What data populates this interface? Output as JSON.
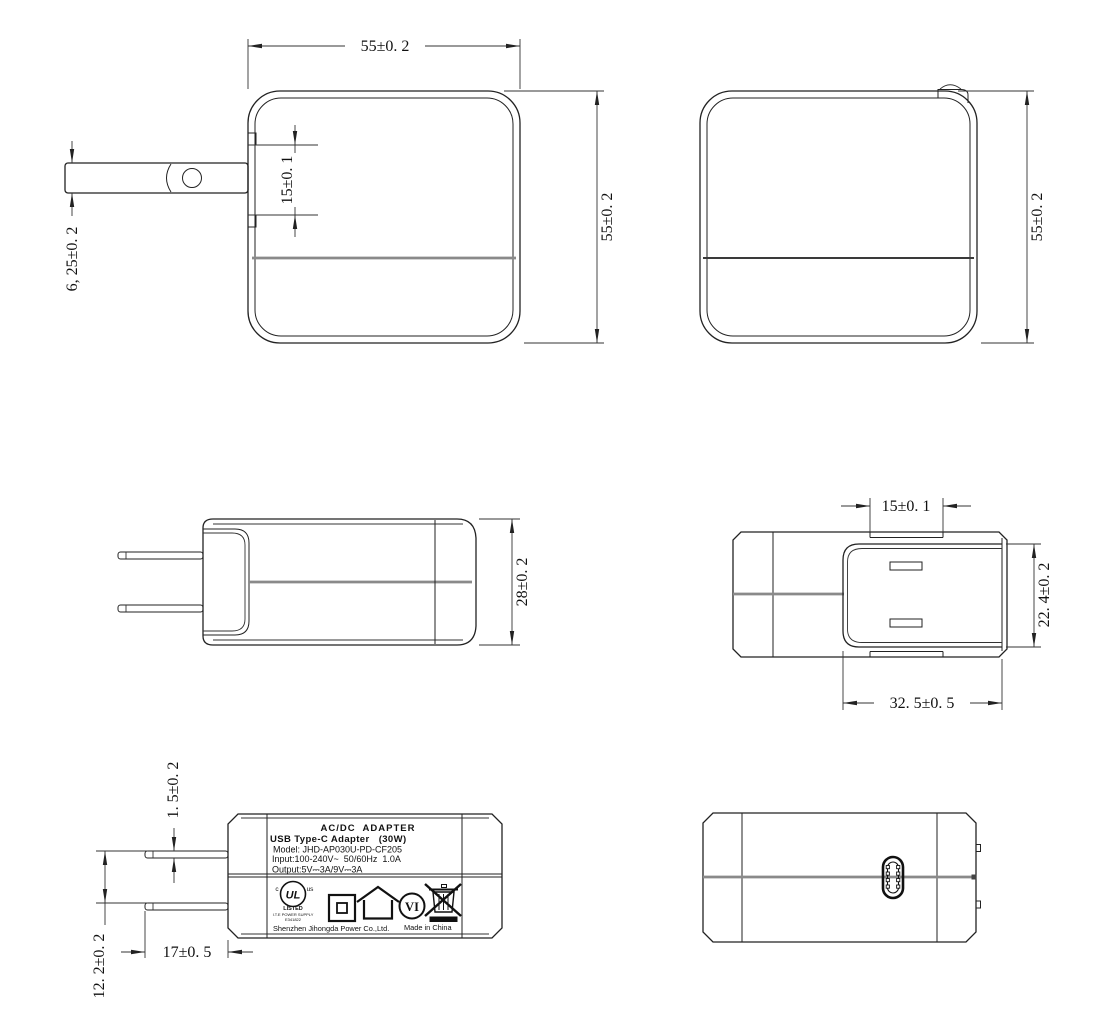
{
  "dimensions": {
    "front_width": "55±0. 2",
    "front_height": "55±0. 2",
    "front_plug_slot": "15±0. 1",
    "prong_blade_width": "6, 25±0. 2",
    "back_height": "55±0. 2",
    "side_thickness": "28±0. 2",
    "top_prong_span": "15±0. 1",
    "top_recess_depth": "22. 4±0. 2",
    "top_recess_width": "32. 5±0. 5",
    "prong_thickness": "1. 5±0. 2",
    "prong_gap": "12. 2±0. 2",
    "prong_length": "17±0. 5"
  },
  "label": {
    "title": "AC/DC  ADAPTER",
    "subtitle": "USB Type-C Adapter   (30W)",
    "model": "Model: JHD-AP030U-PD-CF205",
    "input": "Input:100-240V~  50/60Hz  1.0A",
    "output": "Output:5V⎓3A/9V⎓3A",
    "ul_mark": "UL",
    "ul_c": "c",
    "ul_us": "us",
    "ul_listed": "LISTED",
    "ul_ite": "I.T.E POWER SUPPLY",
    "ul_file": "E341822",
    "efficiency_mark": "VI",
    "manufacturer": "Shenzhen Jihongda Power Co.,Ltd.",
    "made_in": "Made in China"
  },
  "colors": {
    "line": "#222222",
    "divider_gray": "#8a8a8a",
    "dim_text": "#111111"
  }
}
